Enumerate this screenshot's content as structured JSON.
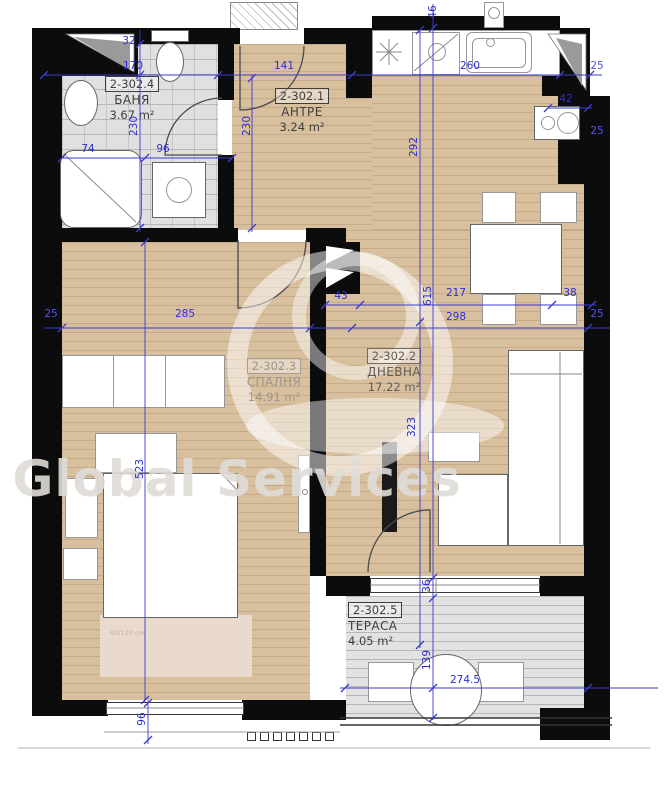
{
  "watermark": {
    "brand": "Global Services"
  },
  "rooms": {
    "bathroom": {
      "id": "2-302.4",
      "name": "БАНЯ",
      "area": "3.67 m²"
    },
    "entry": {
      "id": "2-302.1",
      "name": "АНТРЕ",
      "area": "3.24 m²"
    },
    "bedroom": {
      "id": "2-302.3",
      "name": "СПАЛНЯ",
      "area": "14.91 m²"
    },
    "living": {
      "id": "2-302.2",
      "name": "ДНЕВНА",
      "area": "17.22 m²"
    },
    "terrace": {
      "id": "2-302.5",
      "name": "ТЕРАСА",
      "area": "4.05 m²"
    }
  },
  "dims": {
    "d32": "32",
    "d170": "170",
    "d141": "141",
    "d260": "260",
    "d25_top": "25",
    "d42": "42",
    "d25_right_mid": "25",
    "d74": "74",
    "d96_bath": "96",
    "d230_bath": "230",
    "d230_hall": "230",
    "d292": "292",
    "d46": "46",
    "d43": "43",
    "d217": "217",
    "d38": "38",
    "d298": "298",
    "d25_right_low": "25",
    "d285": "285",
    "d25_left": "25",
    "d615": "615",
    "d523": "523",
    "d323": "323",
    "d36": "36",
    "d139": "139",
    "d274_5": "274.5",
    "d96_bottom": "96"
  },
  "notes": {
    "rug": "60/120 cm"
  },
  "colors": {
    "dimension_blue": "#2e2ecf",
    "wall_black": "#0c0c0c",
    "wood_floor": "#d8bf9e",
    "tile_gray": "#e0e0e0",
    "terrace_gray": "#e2e2e2",
    "watermark_gray": "#dfdcd7"
  }
}
